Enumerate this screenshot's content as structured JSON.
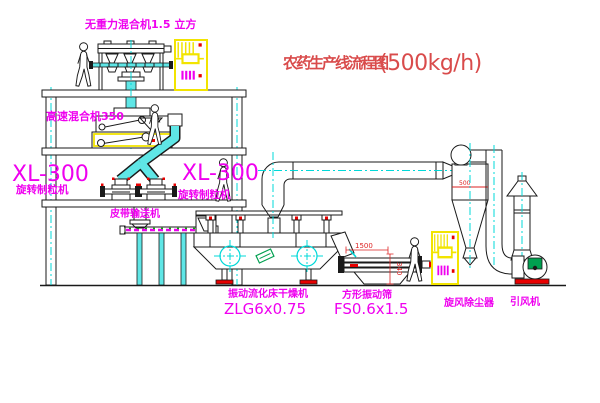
{
  "title": {
    "name": "农药生产线流程图",
    "capacity": "(500kg/h)"
  },
  "equipment": {
    "gravity_mixer": {
      "label": "无重力混合机1.5 立方"
    },
    "high_speed_mixer": {
      "label": "高速混合机350"
    },
    "granulator_left": {
      "model": "XL-300",
      "label": "旋转制粒机"
    },
    "granulator_right": {
      "model": "XL-300",
      "label": "旋转制粒机"
    },
    "belt_conveyor": {
      "label": "皮带输送机"
    },
    "fluid_bed_dryer": {
      "label": "振动流化床干燥机",
      "model": "ZLG6x0.75"
    },
    "vibrating_sieve": {
      "label": "方形振动筛",
      "model": "FS0.6x1.5"
    },
    "cyclone": {
      "label": "旋风除尘器"
    },
    "induced_draft_fan": {
      "label": "引风机"
    }
  },
  "dimensions": {
    "sieve_length": "1500",
    "sieve_height": "340",
    "cyclone_dia": "500"
  },
  "colors": {
    "label_magenta": "#ef00ef",
    "title_red": "#d94b4b",
    "centerline_cyan": "#00d8d8",
    "cabinet_yellow": "#f2e400",
    "accent_red": "#e80000",
    "motor_green": "#00a050",
    "line_black": "#1a1a1a",
    "background": "#ffffff"
  }
}
